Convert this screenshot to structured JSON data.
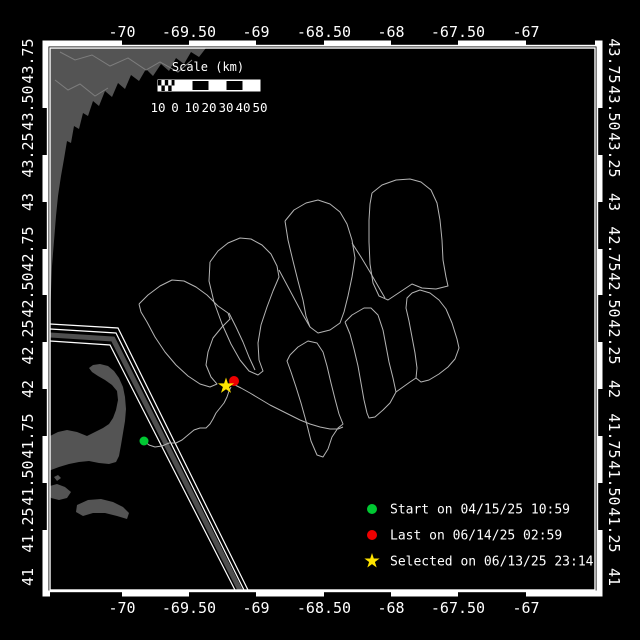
{
  "map_meta": {
    "kind": "glider-track-map",
    "background": "#000000",
    "frame": {
      "x": 50,
      "y": 48,
      "w": 545,
      "h": 542
    },
    "land_color": "#545454",
    "lane_color": "#4f4f4f",
    "track_color": "#b4b4b4",
    "frame_color": "#ffffff"
  },
  "axes": {
    "lon_ticks": [
      {
        "label": "-70",
        "x": 122
      },
      {
        "label": "-69.50",
        "x": 189
      },
      {
        "label": "-69",
        "x": 256
      },
      {
        "label": "-68.50",
        "x": 324
      },
      {
        "label": "-68",
        "x": 391
      },
      {
        "label": "-67.50",
        "x": 458
      },
      {
        "label": "-67",
        "x": 526
      }
    ],
    "lat_ticks": [
      {
        "label": "43.75",
        "y": 61
      },
      {
        "label": "43.50",
        "y": 108
      },
      {
        "label": "43.25",
        "y": 155
      },
      {
        "label": "43",
        "y": 202
      },
      {
        "label": "42.75",
        "y": 249
      },
      {
        "label": "42.50",
        "y": 295
      },
      {
        "label": "42.25",
        "y": 342
      },
      {
        "label": "42",
        "y": 389
      },
      {
        "label": "41.75",
        "y": 436
      },
      {
        "label": "41.50",
        "y": 483
      },
      {
        "label": "41.25",
        "y": 530
      },
      {
        "label": "41",
        "y": 577
      }
    ]
  },
  "border": {
    "top_black": [
      [
        122,
        189
      ],
      [
        256,
        324
      ],
      [
        391,
        458
      ],
      [
        526,
        595
      ]
    ],
    "bottom_black": [
      [
        50,
        122
      ],
      [
        189,
        256
      ],
      [
        324,
        391
      ],
      [
        458,
        526
      ]
    ],
    "left_black": [
      [
        108,
        155
      ],
      [
        202,
        249
      ],
      [
        295,
        342
      ],
      [
        389,
        436
      ],
      [
        483,
        530
      ]
    ],
    "right_black": [
      [
        108,
        155
      ],
      [
        202,
        249
      ],
      [
        295,
        342
      ],
      [
        389,
        436
      ],
      [
        483,
        530
      ]
    ]
  },
  "scalebar": {
    "title": "Scale (km)",
    "title_x": 208,
    "title_y": 71,
    "x": 158,
    "y": 80,
    "w": 102,
    "h": 11,
    "checker_end": 175,
    "black_cells": [
      [
        192,
        209
      ],
      [
        226,
        243
      ]
    ],
    "dividers": [
      175,
      192,
      209,
      226,
      243
    ],
    "label_y": 112,
    "labels": [
      {
        "t": "10",
        "x": 158
      },
      {
        "t": "0",
        "x": 175
      },
      {
        "t": "10",
        "x": 192
      },
      {
        "t": "20",
        "x": 209
      },
      {
        "t": "30",
        "x": 226
      },
      {
        "t": "40",
        "x": 243
      },
      {
        "t": "50",
        "x": 260
      }
    ]
  },
  "legend": {
    "marker_x": 372,
    "label_x": 390,
    "rows": [
      {
        "marker": "dot",
        "color": "#00c832",
        "y": 509,
        "label": "Start on 04/15/25 10:59"
      },
      {
        "marker": "dot",
        "color": "#ee0000",
        "y": 535,
        "label": "Last on 06/14/25 02:59"
      },
      {
        "marker": "star",
        "color": "#ffe400",
        "y": 561,
        "label": "Selected on 06/13/25 23:14"
      }
    ]
  },
  "markers": [
    {
      "name": "start-marker",
      "shape": "dot",
      "color": "#00c832",
      "x": 144,
      "y": 441,
      "r": 4.5
    },
    {
      "name": "last-marker",
      "shape": "dot",
      "color": "#ee0000",
      "x": 234,
      "y": 381,
      "r": 5
    },
    {
      "name": "selected-marker",
      "shape": "star",
      "color": "#ffe400",
      "x": 226,
      "y": 386,
      "r": 8.5
    }
  ],
  "land_polygons": [
    [
      [
        50,
        48
      ],
      [
        206,
        48
      ],
      [
        199,
        57
      ],
      [
        191,
        52
      ],
      [
        184,
        64
      ],
      [
        176,
        58
      ],
      [
        169,
        71
      ],
      [
        161,
        64
      ],
      [
        153,
        76
      ],
      [
        146,
        69
      ],
      [
        139,
        81
      ],
      [
        131,
        75
      ],
      [
        125,
        89
      ],
      [
        118,
        83
      ],
      [
        112,
        97
      ],
      [
        105,
        91
      ],
      [
        99,
        106
      ],
      [
        93,
        101
      ],
      [
        88,
        116
      ],
      [
        83,
        113
      ],
      [
        79,
        129
      ],
      [
        74,
        126
      ],
      [
        71,
        143
      ],
      [
        67,
        141
      ],
      [
        64,
        159
      ],
      [
        61,
        176
      ],
      [
        58,
        196
      ],
      [
        56,
        216
      ],
      [
        54,
        241
      ],
      [
        52,
        266
      ],
      [
        51,
        291
      ],
      [
        50,
        312
      ]
    ],
    [
      [
        50,
        436
      ],
      [
        58,
        432
      ],
      [
        67,
        430
      ],
      [
        77,
        432
      ],
      [
        87,
        436
      ],
      [
        95,
        432
      ],
      [
        103,
        428
      ],
      [
        109,
        424
      ],
      [
        113,
        418
      ],
      [
        116,
        410
      ],
      [
        118,
        400
      ],
      [
        117,
        391
      ],
      [
        112,
        385
      ],
      [
        105,
        380
      ],
      [
        98,
        376
      ],
      [
        92,
        372
      ],
      [
        89,
        368
      ],
      [
        93,
        365
      ],
      [
        100,
        364
      ],
      [
        108,
        366
      ],
      [
        114,
        371
      ],
      [
        119,
        378
      ],
      [
        123,
        387
      ],
      [
        125,
        397
      ],
      [
        126,
        409
      ],
      [
        125,
        421
      ],
      [
        123,
        433
      ],
      [
        121,
        445
      ],
      [
        119,
        456
      ],
      [
        116,
        462
      ],
      [
        109,
        464
      ],
      [
        99,
        463
      ],
      [
        89,
        461
      ],
      [
        79,
        462
      ],
      [
        69,
        464
      ],
      [
        59,
        467
      ],
      [
        51,
        470
      ],
      [
        50,
        471
      ]
    ],
    [
      [
        50,
        486
      ],
      [
        57,
        484
      ],
      [
        65,
        487
      ],
      [
        71,
        492
      ],
      [
        67,
        498
      ],
      [
        59,
        500
      ],
      [
        51,
        498
      ],
      [
        50,
        496
      ]
    ],
    [
      [
        54,
        477
      ],
      [
        58,
        475
      ],
      [
        61,
        478
      ],
      [
        57,
        481
      ]
    ],
    [
      [
        77,
        505
      ],
      [
        88,
        500
      ],
      [
        101,
        499
      ],
      [
        113,
        502
      ],
      [
        123,
        507
      ],
      [
        129,
        513
      ],
      [
        127,
        519
      ],
      [
        117,
        516
      ],
      [
        105,
        513
      ],
      [
        93,
        513
      ],
      [
        83,
        516
      ],
      [
        76,
        512
      ]
    ]
  ],
  "coast_texture": [
    [
      [
        60,
        52
      ],
      [
        75,
        60
      ],
      [
        92,
        55
      ],
      [
        110,
        66
      ],
      [
        128,
        58
      ],
      [
        146,
        70
      ],
      [
        160,
        62
      ],
      [
        178,
        72
      ],
      [
        192,
        60
      ]
    ],
    [
      [
        55,
        80
      ],
      [
        68,
        90
      ],
      [
        80,
        84
      ],
      [
        95,
        96
      ],
      [
        108,
        88
      ]
    ]
  ],
  "lanes": {
    "white_lines": [
      [
        [
          50,
          324
        ],
        [
          118,
          328
        ],
        [
          248,
          590
        ]
      ],
      [
        [
          50,
          329
        ],
        [
          116,
          333
        ],
        [
          244,
          590
        ]
      ],
      [
        [
          50,
          341
        ],
        [
          110,
          345
        ],
        [
          235,
          590
        ]
      ]
    ],
    "gray_stripe": [
      [
        50,
        335
      ],
      [
        113,
        339
      ],
      [
        240,
        590
      ]
    ]
  },
  "track_polylines": [
    [
      [
        139,
        304
      ],
      [
        148,
        295
      ],
      [
        160,
        286
      ],
      [
        172,
        280
      ],
      [
        184,
        281
      ],
      [
        196,
        287
      ],
      [
        207,
        295
      ],
      [
        218,
        306
      ],
      [
        228,
        313
      ],
      [
        230,
        319
      ],
      [
        222,
        327
      ],
      [
        213,
        338
      ],
      [
        208,
        352
      ],
      [
        206,
        365
      ],
      [
        211,
        377
      ],
      [
        217,
        384
      ],
      [
        210,
        387
      ],
      [
        200,
        384
      ],
      [
        188,
        376
      ],
      [
        176,
        365
      ],
      [
        165,
        352
      ],
      [
        155,
        337
      ],
      [
        147,
        322
      ],
      [
        141,
        312
      ],
      [
        139,
        304
      ]
    ],
    [
      [
        210,
        262
      ],
      [
        218,
        251
      ],
      [
        228,
        243
      ],
      [
        240,
        238
      ],
      [
        251,
        239
      ],
      [
        262,
        245
      ],
      [
        271,
        254
      ],
      [
        277,
        266
      ],
      [
        279,
        277
      ],
      [
        273,
        291
      ],
      [
        267,
        307
      ],
      [
        261,
        325
      ],
      [
        258,
        343
      ],
      [
        259,
        360
      ],
      [
        263,
        371
      ],
      [
        258,
        375
      ],
      [
        249,
        371
      ],
      [
        240,
        360
      ],
      [
        231,
        344
      ],
      [
        222,
        324
      ],
      [
        214,
        302
      ],
      [
        209,
        281
      ],
      [
        210,
        262
      ]
    ],
    [
      [
        285,
        221
      ],
      [
        294,
        210
      ],
      [
        306,
        203
      ],
      [
        318,
        200
      ],
      [
        330,
        204
      ],
      [
        340,
        212
      ],
      [
        347,
        224
      ],
      [
        352,
        240
      ],
      [
        355,
        258
      ],
      [
        352,
        277
      ],
      [
        348,
        296
      ],
      [
        344,
        312
      ],
      [
        340,
        323
      ],
      [
        330,
        330
      ],
      [
        318,
        333
      ],
      [
        310,
        327
      ],
      [
        306,
        316
      ],
      [
        303,
        300
      ],
      [
        298,
        281
      ],
      [
        293,
        261
      ],
      [
        288,
        240
      ],
      [
        285,
        221
      ]
    ],
    [
      [
        372,
        193
      ],
      [
        382,
        185
      ],
      [
        396,
        180
      ],
      [
        410,
        179
      ],
      [
        421,
        182
      ],
      [
        431,
        190
      ],
      [
        437,
        203
      ],
      [
        440,
        220
      ],
      [
        442,
        240
      ],
      [
        443,
        260
      ],
      [
        446,
        277
      ],
      [
        448,
        286
      ],
      [
        436,
        289
      ],
      [
        422,
        288
      ],
      [
        412,
        284
      ],
      [
        400,
        292
      ],
      [
        388,
        300
      ],
      [
        379,
        296
      ],
      [
        373,
        283
      ],
      [
        370,
        264
      ],
      [
        369,
        242
      ],
      [
        369,
        220
      ],
      [
        370,
        204
      ],
      [
        372,
        193
      ]
    ],
    [
      [
        290,
        355
      ],
      [
        298,
        347
      ],
      [
        308,
        341
      ],
      [
        317,
        343
      ],
      [
        323,
        352
      ],
      [
        327,
        366
      ],
      [
        331,
        383
      ],
      [
        335,
        399
      ],
      [
        339,
        414
      ],
      [
        343,
        424
      ],
      [
        338,
        428
      ],
      [
        332,
        437
      ],
      [
        328,
        449
      ],
      [
        323,
        457
      ],
      [
        317,
        455
      ],
      [
        311,
        441
      ],
      [
        306,
        421
      ],
      [
        301,
        403
      ],
      [
        296,
        387
      ],
      [
        291,
        372
      ],
      [
        287,
        361
      ],
      [
        290,
        355
      ]
    ],
    [
      [
        345,
        322
      ],
      [
        352,
        315
      ],
      [
        364,
        308
      ],
      [
        371,
        308
      ],
      [
        378,
        315
      ],
      [
        383,
        330
      ],
      [
        386,
        346
      ],
      [
        389,
        362
      ],
      [
        393,
        378
      ],
      [
        396,
        392
      ],
      [
        390,
        403
      ],
      [
        383,
        410
      ],
      [
        375,
        417
      ],
      [
        369,
        418
      ],
      [
        367,
        413
      ],
      [
        364,
        400
      ],
      [
        361,
        383
      ],
      [
        358,
        366
      ],
      [
        354,
        349
      ],
      [
        350,
        334
      ],
      [
        345,
        322
      ]
    ],
    [
      [
        412,
        293
      ],
      [
        420,
        290
      ],
      [
        430,
        293
      ],
      [
        439,
        300
      ],
      [
        446,
        309
      ],
      [
        452,
        323
      ],
      [
        457,
        339
      ],
      [
        459,
        348
      ],
      [
        455,
        359
      ],
      [
        448,
        367
      ],
      [
        439,
        374
      ],
      [
        429,
        380
      ],
      [
        421,
        382
      ],
      [
        416,
        378
      ],
      [
        417,
        368
      ],
      [
        415,
        353
      ],
      [
        412,
        337
      ],
      [
        409,
        321
      ],
      [
        406,
        308
      ],
      [
        407,
        298
      ],
      [
        412,
        293
      ]
    ],
    [
      [
        144,
        441
      ],
      [
        149,
        445
      ],
      [
        155,
        447
      ],
      [
        162,
        446
      ],
      [
        169,
        443
      ],
      [
        176,
        443
      ],
      [
        182,
        440
      ],
      [
        188,
        435
      ],
      [
        194,
        430
      ],
      [
        200,
        428
      ],
      [
        206,
        428
      ],
      [
        210,
        424
      ],
      [
        213,
        419
      ],
      [
        216,
        413
      ],
      [
        220,
        408
      ],
      [
        224,
        403
      ],
      [
        227,
        397
      ],
      [
        229,
        391
      ],
      [
        231,
        387
      ]
    ],
    [
      [
        233,
        384
      ],
      [
        241,
        388
      ],
      [
        250,
        393
      ],
      [
        260,
        399
      ],
      [
        270,
        405
      ],
      [
        280,
        410
      ],
      [
        290,
        415
      ],
      [
        300,
        420
      ],
      [
        310,
        424
      ],
      [
        320,
        427
      ],
      [
        330,
        429
      ],
      [
        338,
        429
      ],
      [
        343,
        427
      ]
    ],
    [
      [
        229,
        313
      ],
      [
        236,
        327
      ],
      [
        243,
        342
      ],
      [
        249,
        357
      ],
      [
        255,
        370
      ]
    ],
    [
      [
        279,
        270
      ],
      [
        287,
        285
      ],
      [
        295,
        300
      ],
      [
        303,
        315
      ],
      [
        310,
        327
      ]
    ],
    [
      [
        352,
        243
      ],
      [
        361,
        257
      ],
      [
        370,
        272
      ],
      [
        378,
        286
      ],
      [
        385,
        298
      ]
    ],
    [
      [
        396,
        392
      ],
      [
        403,
        387
      ],
      [
        410,
        382
      ],
      [
        416,
        378
      ]
    ]
  ]
}
